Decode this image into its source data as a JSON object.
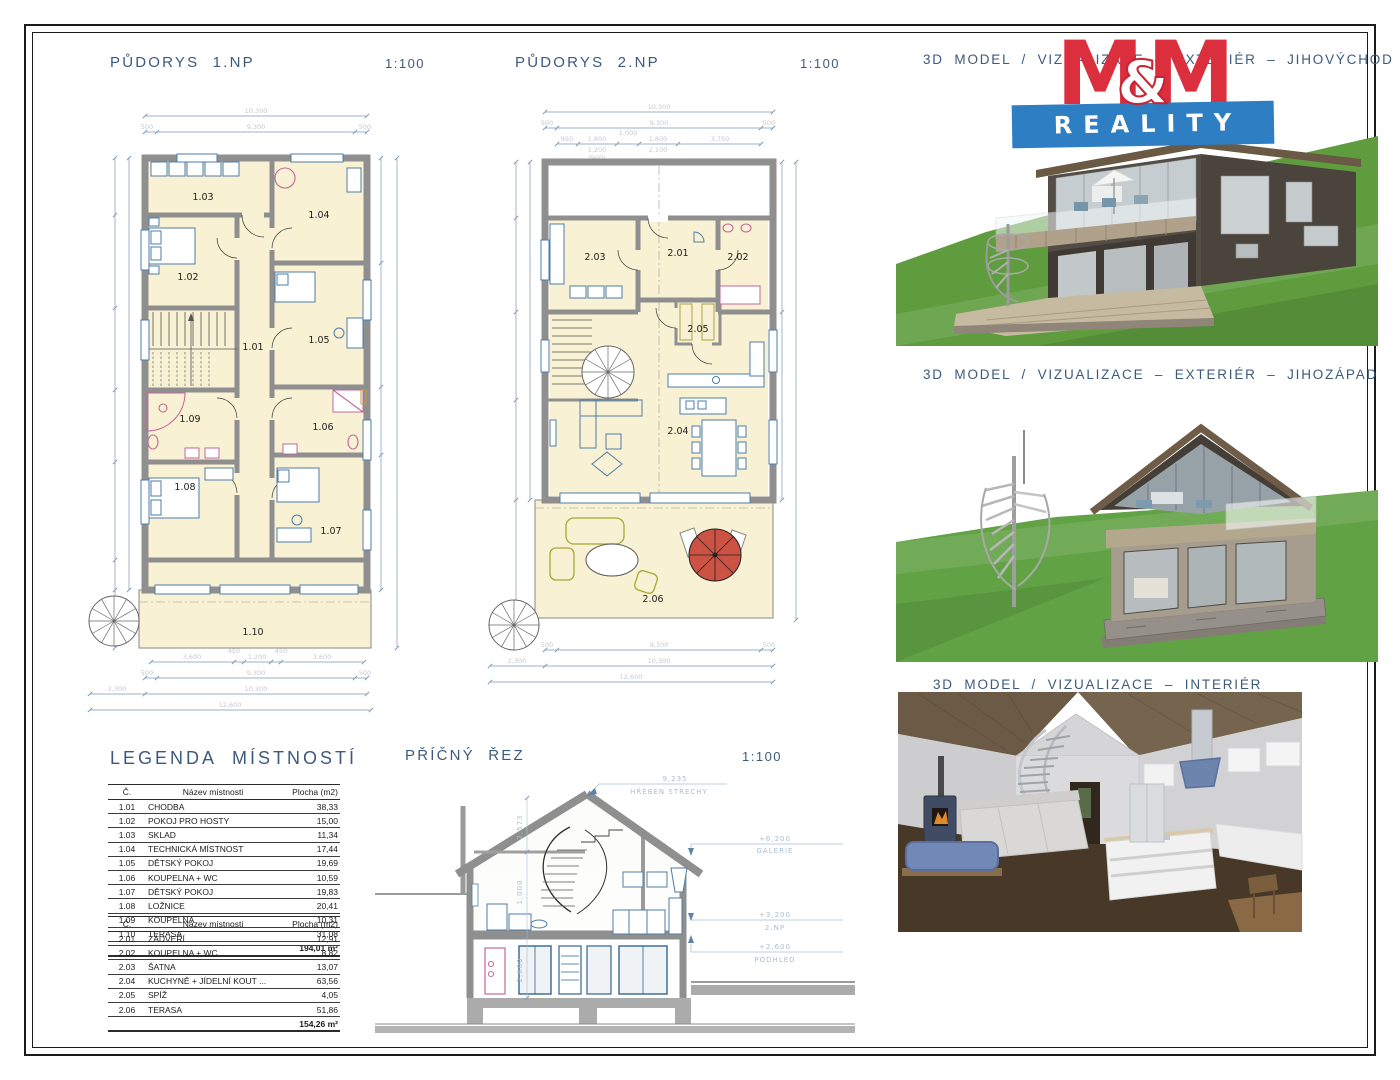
{
  "plan1": {
    "title": "PŮDORYS 1.NP",
    "scale": "1:100",
    "rooms": [
      "1.01",
      "1.02",
      "1.03",
      "1.04",
      "1.05",
      "1.06",
      "1.07",
      "1.08",
      "1.09",
      "1.10"
    ],
    "dims_top": [
      "10,300",
      "500",
      "9,300",
      "500"
    ],
    "dims_bottom": [
      "3,600",
      "450",
      "1,200",
      "450",
      "3,600",
      "500",
      "9,300",
      "500",
      "2,300",
      "10,300",
      "12,600"
    ]
  },
  "plan2": {
    "title": "PŮDORYS 2.NP",
    "scale": "1:100",
    "rooms": [
      "2.01",
      "2.02",
      "2.03",
      "2.04",
      "2.05",
      "2.06"
    ],
    "dims_top": [
      "10,300",
      "500",
      "9,300",
      "500",
      "950",
      "1,800",
      "1,000",
      "1,800",
      "3,750",
      "1,200",
      "(900)",
      "2,100"
    ],
    "dims_bottom": [
      "500",
      "9,300",
      "500",
      "2,300",
      "10,300",
      "12,600"
    ]
  },
  "section": {
    "title": "PŘÍČNÝ ŘEZ",
    "scale": "1:100",
    "levels": [
      {
        "value": "9,235",
        "label": "HŘEBEN STŘECHY"
      },
      {
        "value": "+6,200",
        "label": "GALERIE"
      },
      {
        "value": "+3,200",
        "label": "2.NP"
      },
      {
        "value": "+2,600",
        "label": "PODHLED"
      }
    ],
    "vdims": [
      "2,573",
      "1,000",
      "2,600"
    ]
  },
  "renders": [
    {
      "title": "3D MODEL / VIZUALIZACE – EXTERIÉR – JIHOVÝCHOD"
    },
    {
      "title": "3D MODEL / VIZUALIZACE – EXTERIÉR – JIHOZÁPAD"
    },
    {
      "title": "3D MODEL / VIZUALIZACE – INTERIÉR"
    }
  ],
  "logo": {
    "m1": "M",
    "amp": "&",
    "m2": "M",
    "reality": "REALITY"
  },
  "legend": {
    "title": "LEGENDA MÍSTNOSTÍ",
    "headers": [
      "Č.",
      "Název místnosti",
      "Plocha (m2)"
    ],
    "floor1": {
      "rows": [
        [
          "1.01",
          "CHODBA",
          "38,33"
        ],
        [
          "1.02",
          "POKOJ PRO HOSTY",
          "15,00"
        ],
        [
          "1.03",
          "SKLAD",
          "11,34"
        ],
        [
          "1.04",
          "TECHNICKÁ MÍSTNOST",
          "17,44"
        ],
        [
          "1.05",
          "DĚTSKÝ POKOJ",
          "19,69"
        ],
        [
          "1.06",
          "KOUPELNA + WC",
          "10,59"
        ],
        [
          "1.07",
          "DĚTSKÝ POKOJ",
          "19,83"
        ],
        [
          "1.08",
          "LOŽNICE",
          "20,41"
        ],
        [
          "1.09",
          "KOUPELNA",
          "10,31"
        ],
        [
          "1.10",
          "TERASA",
          "31,08"
        ]
      ],
      "total": "194,01 m²"
    },
    "floor2": {
      "rows": [
        [
          "2.01",
          "ZÁDVEŘÍ",
          "12,91"
        ],
        [
          "2.02",
          "KOUPELNA + WC",
          "8,82"
        ],
        [
          "2.03",
          "ŠATNA",
          "13,07"
        ],
        [
          "2.04",
          "KUCHYNĚ + JÍDELNÍ KOUT ...",
          "63,56"
        ],
        [
          "2.05",
          "SPÍŽ",
          "4,05"
        ],
        [
          "2.06",
          "TERASA",
          "51,86"
        ]
      ],
      "total": "154,26 m²"
    }
  }
}
